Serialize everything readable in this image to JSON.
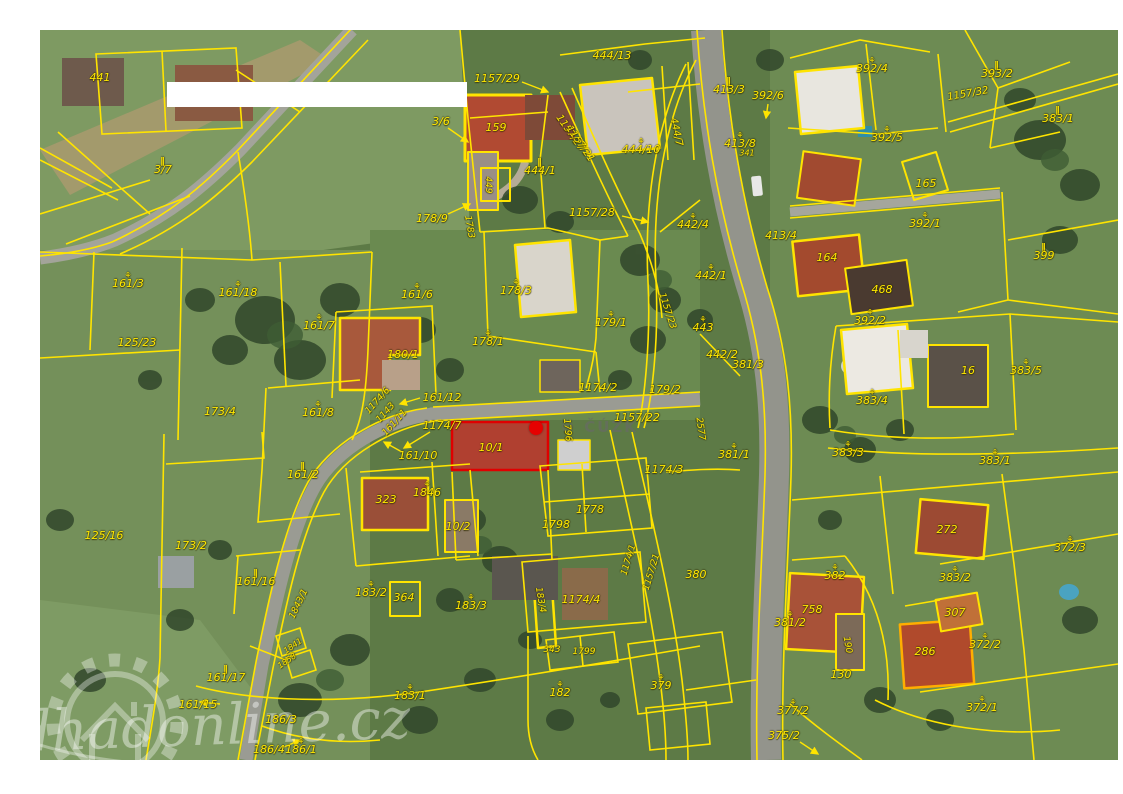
{
  "map": {
    "marker_color": "#e60000",
    "line_color": "#ffe400",
    "watermark_cuzk": "© ČÚZK",
    "watermark_site": "odhadonline.cz",
    "labels": [
      {
        "t": "441",
        "x": 100,
        "y": 78
      },
      {
        "t": "3/7",
        "x": 163,
        "y": 167,
        "i": "m"
      },
      {
        "t": "3/6",
        "x": 441,
        "y": 122
      },
      {
        "t": "1157/29",
        "x": 497,
        "y": 79
      },
      {
        "t": "444/13",
        "x": 612,
        "y": 56
      },
      {
        "t": "159",
        "x": 496,
        "y": 128
      },
      {
        "t": "444/1",
        "x": 540,
        "y": 168,
        "i": "m"
      },
      {
        "t": "444/10",
        "x": 641,
        "y": 147,
        "i": "f"
      },
      {
        "t": "444/7",
        "x": 676,
        "y": 132,
        "r": 78,
        "s": 10
      },
      {
        "t": "1157/27",
        "x": 570,
        "y": 133,
        "r": 55,
        "s": 10
      },
      {
        "t": "1157/21",
        "x": 580,
        "y": 144,
        "r": 55,
        "s": 10
      },
      {
        "t": "1157/28",
        "x": 592,
        "y": 213
      },
      {
        "t": "442/4",
        "x": 693,
        "y": 222,
        "i": "f"
      },
      {
        "t": "449",
        "x": 488,
        "y": 185,
        "r": 90,
        "s": 9
      },
      {
        "t": "1783",
        "x": 469,
        "y": 227,
        "r": 80,
        "s": 9
      },
      {
        "t": "178/9",
        "x": 432,
        "y": 219
      },
      {
        "t": "392/4",
        "x": 872,
        "y": 66,
        "i": "f"
      },
      {
        "t": "413/3",
        "x": 729,
        "y": 87,
        "i": "m"
      },
      {
        "t": "392/6",
        "x": 768,
        "y": 96
      },
      {
        "t": "413/8",
        "x": 740,
        "y": 141,
        "i": "f"
      },
      {
        "t": "341",
        "x": 747,
        "y": 153,
        "s": 8
      },
      {
        "t": "392/5",
        "x": 887,
        "y": 135,
        "i": "f"
      },
      {
        "t": "165",
        "x": 926,
        "y": 184
      },
      {
        "t": "392/1",
        "x": 925,
        "y": 221,
        "i": "f"
      },
      {
        "t": "393/2",
        "x": 997,
        "y": 71,
        "i": "m"
      },
      {
        "t": "383/1",
        "x": 1058,
        "y": 116,
        "i": "m"
      },
      {
        "t": "1157/32",
        "x": 968,
        "y": 94,
        "r": -10,
        "s": 10
      },
      {
        "t": "399",
        "x": 1044,
        "y": 253,
        "i": "m"
      },
      {
        "t": "161/3",
        "x": 128,
        "y": 281,
        "i": "f"
      },
      {
        "t": "161/18",
        "x": 238,
        "y": 290,
        "i": "f"
      },
      {
        "t": "161/7",
        "x": 319,
        "y": 323,
        "i": "f"
      },
      {
        "t": "125/23",
        "x": 137,
        "y": 343
      },
      {
        "t": "173/4",
        "x": 220,
        "y": 412
      },
      {
        "t": "161/8",
        "x": 318,
        "y": 410,
        "i": "f"
      },
      {
        "t": "161/6",
        "x": 417,
        "y": 292,
        "i": "f"
      },
      {
        "t": "178/3",
        "x": 516,
        "y": 288,
        "i": "f"
      },
      {
        "t": "179/1",
        "x": 611,
        "y": 320,
        "i": "f"
      },
      {
        "t": "178/1",
        "x": 488,
        "y": 339,
        "i": "f"
      },
      {
        "t": "180/1",
        "x": 403,
        "y": 355
      },
      {
        "t": "161/12",
        "x": 442,
        "y": 398
      },
      {
        "t": "1174/6",
        "x": 378,
        "y": 401,
        "r": -48,
        "s": 9
      },
      {
        "t": "1143",
        "x": 386,
        "y": 413,
        "r": -48,
        "s": 9
      },
      {
        "t": "161/11",
        "x": 395,
        "y": 423,
        "r": -48,
        "s": 9
      },
      {
        "t": "1174/7",
        "x": 442,
        "y": 426
      },
      {
        "t": "1174/2",
        "x": 598,
        "y": 388
      },
      {
        "t": "1157/22",
        "x": 637,
        "y": 418
      },
      {
        "t": "2577",
        "x": 700,
        "y": 429,
        "r": 82,
        "s": 9
      },
      {
        "t": "1796",
        "x": 567,
        "y": 430,
        "r": 85,
        "s": 9
      },
      {
        "t": "10/1",
        "x": 491,
        "y": 448
      },
      {
        "t": "161/10",
        "x": 418,
        "y": 456
      },
      {
        "t": "1846",
        "x": 427,
        "y": 490,
        "i": "f"
      },
      {
        "t": "323",
        "x": 386,
        "y": 500
      },
      {
        "t": "10/2",
        "x": 458,
        "y": 527
      },
      {
        "t": "1798",
        "x": 556,
        "y": 525
      },
      {
        "t": "1778",
        "x": 590,
        "y": 510
      },
      {
        "t": "442/1",
        "x": 711,
        "y": 273,
        "i": "f"
      },
      {
        "t": "443",
        "x": 703,
        "y": 325,
        "i": "f"
      },
      {
        "t": "1157/23",
        "x": 667,
        "y": 311,
        "r": 72,
        "s": 9
      },
      {
        "t": "442/2",
        "x": 722,
        "y": 355
      },
      {
        "t": "381/3",
        "x": 748,
        "y": 365
      },
      {
        "t": "179/2",
        "x": 665,
        "y": 390
      },
      {
        "t": "413/4",
        "x": 781,
        "y": 236
      },
      {
        "t": "164",
        "x": 827,
        "y": 258
      },
      {
        "t": "468",
        "x": 882,
        "y": 290
      },
      {
        "t": "392/2",
        "x": 870,
        "y": 318,
        "i": "f"
      },
      {
        "t": "383/4",
        "x": 872,
        "y": 398,
        "i": "f"
      },
      {
        "t": "16",
        "x": 968,
        "y": 371
      },
      {
        "t": "383/5",
        "x": 1026,
        "y": 368,
        "i": "f"
      },
      {
        "t": "383/3",
        "x": 848,
        "y": 450,
        "i": "f"
      },
      {
        "t": "383/1",
        "x": 995,
        "y": 458,
        "i": "f"
      },
      {
        "t": "381/1",
        "x": 734,
        "y": 452,
        "i": "f"
      },
      {
        "t": "1174/3",
        "x": 664,
        "y": 470
      },
      {
        "t": "125/16",
        "x": 104,
        "y": 536
      },
      {
        "t": "173/2",
        "x": 191,
        "y": 546
      },
      {
        "t": "161/2",
        "x": 303,
        "y": 472,
        "i": "m"
      },
      {
        "t": "161/16",
        "x": 256,
        "y": 579,
        "i": "m"
      },
      {
        "t": "1843/1",
        "x": 299,
        "y": 604,
        "r": -64,
        "s": 9
      },
      {
        "t": "1841",
        "x": 293,
        "y": 646,
        "r": -35,
        "s": 8
      },
      {
        "t": "1858",
        "x": 287,
        "y": 661,
        "r": -35,
        "s": 8
      },
      {
        "t": "161/17",
        "x": 226,
        "y": 675,
        "i": "m"
      },
      {
        "t": "161/15",
        "x": 198,
        "y": 705
      },
      {
        "t": "186/3",
        "x": 281,
        "y": 720
      },
      {
        "t": "186/4",
        "x": 269,
        "y": 750
      },
      {
        "t": "186/1",
        "x": 301,
        "y": 747,
        "i": "f"
      },
      {
        "t": "183/1",
        "x": 410,
        "y": 693,
        "i": "f"
      },
      {
        "t": "183/2",
        "x": 371,
        "y": 590,
        "i": "f"
      },
      {
        "t": "364",
        "x": 404,
        "y": 598
      },
      {
        "t": "183/3",
        "x": 471,
        "y": 603,
        "i": "f"
      },
      {
        "t": "1174/4",
        "x": 581,
        "y": 600
      },
      {
        "t": "183/4",
        "x": 540,
        "y": 600,
        "r": 80,
        "s": 9
      },
      {
        "t": "380",
        "x": 696,
        "y": 575
      },
      {
        "t": "1174/1",
        "x": 629,
        "y": 560,
        "r": -73,
        "s": 9
      },
      {
        "t": "1157/21",
        "x": 652,
        "y": 572,
        "r": -73,
        "s": 9
      },
      {
        "t": "343",
        "x": 552,
        "y": 650,
        "s": 9
      },
      {
        "t": "1799",
        "x": 584,
        "y": 652,
        "s": 9
      },
      {
        "t": "182",
        "x": 560,
        "y": 690,
        "i": "f"
      },
      {
        "t": "379",
        "x": 661,
        "y": 683,
        "i": "f"
      },
      {
        "t": "272",
        "x": 947,
        "y": 530
      },
      {
        "t": "382",
        "x": 835,
        "y": 573,
        "i": "f"
      },
      {
        "t": "383/2",
        "x": 955,
        "y": 575,
        "i": "f"
      },
      {
        "t": "372/3",
        "x": 1070,
        "y": 545,
        "i": "f"
      },
      {
        "t": "758",
        "x": 812,
        "y": 610
      },
      {
        "t": "307",
        "x": 955,
        "y": 613
      },
      {
        "t": "381/2",
        "x": 790,
        "y": 620,
        "i": "f"
      },
      {
        "t": "190",
        "x": 847,
        "y": 645,
        "r": 80,
        "s": 9
      },
      {
        "t": "130",
        "x": 841,
        "y": 675
      },
      {
        "t": "377/2",
        "x": 793,
        "y": 708,
        "i": "f"
      },
      {
        "t": "375/2",
        "x": 784,
        "y": 736
      },
      {
        "t": "286",
        "x": 925,
        "y": 652
      },
      {
        "t": "372/2",
        "x": 985,
        "y": 642,
        "i": "f"
      },
      {
        "t": "372/1",
        "x": 982,
        "y": 705,
        "i": "f"
      }
    ]
  }
}
